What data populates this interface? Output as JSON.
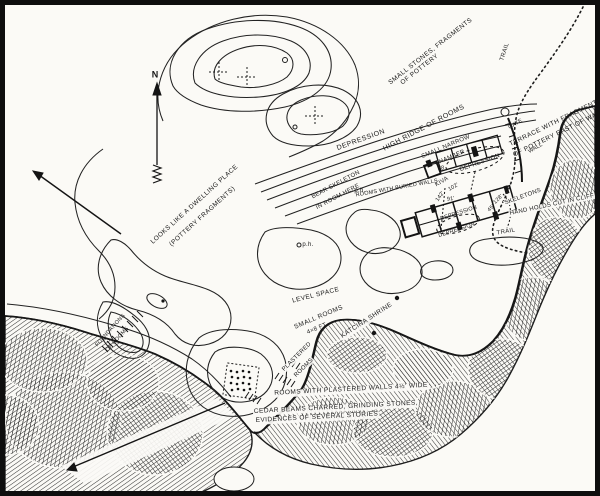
{
  "map": {
    "type": "hand-drawn archaeological ruin site map",
    "ink_color": "#1d1d1d",
    "paper_color": "#fbfaf6",
    "frame_color": "#0e0e0e"
  },
  "compass": {
    "north_label": "N"
  },
  "labels": {
    "small_stones_line1": "SMALL STONES, FRAGMENTS",
    "small_stones_line2": "OF POTTERY",
    "trail_top": "TRAIL",
    "depression_upper": "DEPRESSION",
    "high_ridge": "HIGH RIDGE OF ROOMS",
    "small_narrow_line1": "SMALL NARROW",
    "small_narrow_line2": "CHAMBER",
    "dwelling_line1": "LOOKS LIKE A DWELLING PLACE",
    "dwelling_line2": "(POTTERY FRAGMENTS)",
    "bear_line1": "BEAR SKELETON",
    "bear_line2": "IN ROOM HERE",
    "rooms_buried": "ROOMS WITH BURIED WALLS",
    "kiva": "KIVA",
    "kiva_dim": "102'",
    "num_28": "28",
    "depression_dashed": "DEPRESSION",
    "dim_91": "91'",
    "dim_142": "142'",
    "depression_row1": "DEPRESSION",
    "depression_row2": "DEPRESSION",
    "dim_45": "45'",
    "dim_128": "128'",
    "terrace_line1": "TERRACE WITH FRAGMENTS",
    "terrace_line2": "OF POTTERY EAST OF WALL",
    "gate": "GATE",
    "wall": "WALL",
    "skeletons": "SKELETONS",
    "hand_holds": "HAND HOLDS CUT IN CLIFF",
    "trail_lower": "TRAIL",
    "level_space": "LEVEL SPACE",
    "small_rooms_line1": "SMALL ROOMS",
    "small_rooms_line2": "4×8 FT",
    "plastered_line1": "PLASTERED",
    "plastered_line2": "ROOMS",
    "katcina_shrine": "KATCINA SHRINE",
    "plastered_walls": "ROOMS WITH PLASTERED WALLS 4½' WIDE",
    "cedar_line1": "CEDAR BEAMS CHARRED, GRINDING STONES,",
    "cedar_line2": "EVIDENCES OF SEVERAL STORIES",
    "foundations_line1": "FOUNDATIONS",
    "foundations_line2": "OF ROOMS",
    "pothole_1": "p.h.",
    "pothole_2": "p.h."
  }
}
